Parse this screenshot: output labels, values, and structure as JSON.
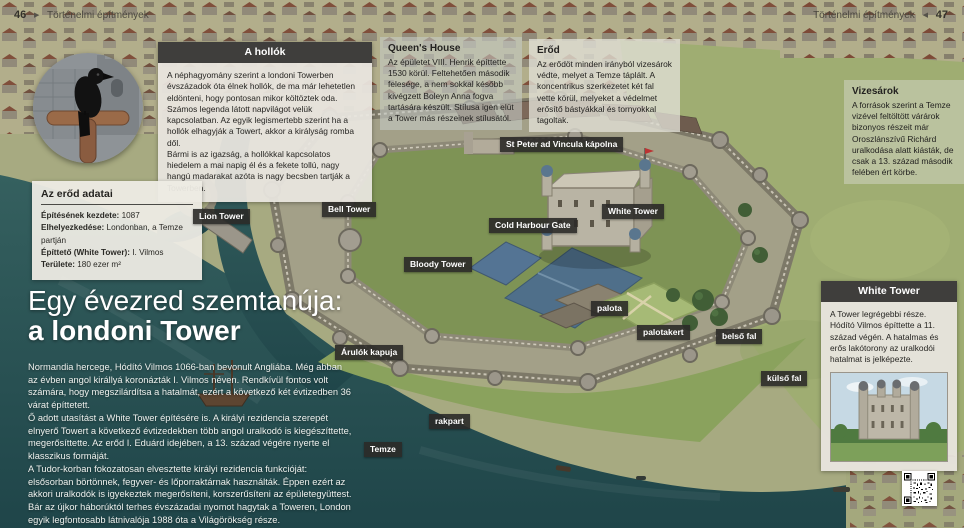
{
  "page_header_left": {
    "page_number": "46",
    "arrow": "▶",
    "title": "Történelmi építmények"
  },
  "page_header_right": {
    "title": "Történelmi építmények",
    "arrow": "◀",
    "page_number": "47"
  },
  "callouts": {
    "ravens": {
      "title": "A hollók",
      "paras": [
        "A néphagyomány szerint a londoni Towerben évszázadok óta élnek hollók, de ma már lehetetlen eldönteni, hogy pontosan mikor költöztek oda.",
        "Számos legenda látott napvilágot velük kapcsolatban. Az egyik legismertebb szerint ha a hollók elhagyják a Towert, akkor a királyság romba dől.",
        "Bármi is az igazság, a hollókkal kapcsolatos hiedelem a mai napig él és a fekete tollú, nagy hangú madarakat azóta is nagy becsben tartják a Towerben."
      ]
    },
    "queens_house": {
      "title": "Queen's House",
      "body": "Az épületet VIII. Henrik építtette 1530 körül. Feltehetően második felesége, a nem sokkal később kivégzett Boleyn Anna fogva tartására készült. Stílusa igen elüt a Tower más részeinek stílusától."
    },
    "fort": {
      "title": "Erőd",
      "body": "Az erődöt minden irányból vizesárok védte, melyet a Temze táplált. A koncentrikus szerkezetet két fal vette körül, melyeket a védelmet erősítő bástyákkal és tornyokkal tagoltak."
    },
    "moat": {
      "title": "Vizesárok",
      "body": "A források szerint a Temze vizével feltöltött várárok bizonyos részeit már Oroszlánszívű Richárd uralkodása alatt kiásták, de csak a 13. század második felében ért körbe."
    },
    "white_tower": {
      "title": "White Tower",
      "body": "A Tower legrégebbi része. Hódító Vilmos építtette a 11. század végén. A hatalmas és erős lakótorony az uralkodói hatalmat is jelképezte."
    }
  },
  "fact_box": {
    "title": "Az erőd adatai",
    "items": [
      {
        "label": "Építésének kezdete:",
        "value": "1087"
      },
      {
        "label": "Elhelyezkedése:",
        "value": "Londonban, a Temze partján"
      },
      {
        "label": "Építtető (White Tower):",
        "value": "I. Vilmos"
      },
      {
        "label": "Területe:",
        "value": "180 ezer m²"
      }
    ]
  },
  "main": {
    "title_line1": "Egy évezred szemtanúja:",
    "title_line2": "a londoni Tower",
    "paragraphs": [
      "Normandia hercege, Hódító Vilmos 1066-ban bevonult Angliába. Még abban az évben angol királlyá koronázták I. Vilmos néven. Rendkívül fontos volt számára, hogy megszilárdítsa a hatalmát, ezért a következő két évtizedben 36 várat építtetett.",
      "Ő adott utasítást a White Tower építésére is. A királyi rezidencia szerepét elnyerő Towert a következő évtizedekben több angol uralkodó is kiegészíttette, megerősíttette. Az erőd I. Eduárd idejében, a 13. század végére nyerte el klasszikus formáját.",
      "A Tudor-korban fokozatosan elvesztette királyi rezidencia funkcióját: elsősorban börtönnek, fegyver- és lőporraktárnak használták. Éppen ezért az akkori uralkodók is igyekeztek megerősíteni, korszerűsíteni az épületegyüttest.",
      "Bár az újkor háborúktól terhes évszázadai nyomot hagytak a Toweren, London egyik legfontosabb látnivalója 1988 óta a Világörökség része."
    ]
  },
  "map_labels": [
    {
      "text": "Lion Tower"
    },
    {
      "text": "Bell Tower"
    },
    {
      "text": "Bloody Tower"
    },
    {
      "text": "St Peter ad Vincula kápolna"
    },
    {
      "text": "Cold Harbour Gate"
    },
    {
      "text": "White Tower"
    },
    {
      "text": "palota"
    },
    {
      "text": "palotakert"
    },
    {
      "text": "belső fal"
    },
    {
      "text": "külső fal"
    },
    {
      "text": "Árulók kapuja"
    },
    {
      "text": "rakpart"
    },
    {
      "text": "Temze"
    }
  ],
  "icons": {
    "qr_code": "qr-code",
    "raven_photo": "raven-photo",
    "white_tower_photo": "white-tower-photo"
  },
  "colors": {
    "water": "#2a5356",
    "land": "#a7aa81",
    "map_label_bg": "#2b2a28",
    "callout_header_bg": "#3f3e3c",
    "callout_body_bg": "#e9e6df",
    "title_text": "#ffffff"
  }
}
